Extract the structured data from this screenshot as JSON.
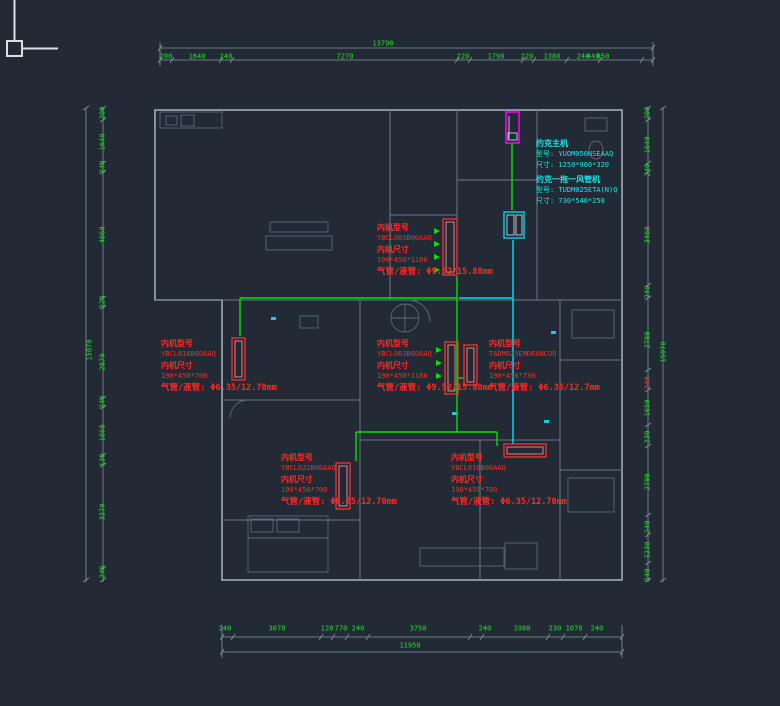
{
  "drawing": {
    "type": "hvac-floor-plan",
    "background": "#212a35",
    "dim_color": "#21e321",
    "annotation_color": "#ff2a24",
    "outdoor_note_color": "#17e8e8",
    "pipe_colors": {
      "gas_line_green": "#00e400",
      "liquid_line_cyan": "#00e0ff"
    },
    "unit_outline_colors": {
      "indoor": "#ff2f2f",
      "outdoor_main": "#ff00ff",
      "ducted": "#00e0ff"
    }
  },
  "dims": {
    "top": {
      "total": "13790",
      "segments": [
        "200",
        "1640",
        "240",
        "7270",
        "220",
        "1790",
        "220",
        "1380",
        "240",
        "440",
        "850"
      ]
    },
    "bottom": {
      "total": "11950",
      "segments": [
        "240",
        "3070",
        "120",
        "770",
        "240",
        "3750",
        "240",
        "1980",
        "230",
        "1070",
        "240"
      ]
    },
    "left": {
      "total": "15070",
      "segments": [
        "200",
        "1640",
        "240",
        "4060",
        "220",
        "2870",
        "240",
        "1860",
        "130",
        "3370",
        "240"
      ]
    },
    "right": {
      "total": "15070",
      "segments": [
        "200",
        "1640",
        "240",
        "3460",
        "240",
        "2780",
        "1650",
        "230",
        "2790",
        "240",
        "1230",
        "240"
      ],
      "red_segment": "240"
    }
  },
  "note_labels": {
    "model": "内机型号",
    "size": "内机尺寸"
  },
  "outdoor_note": {
    "title1": "约克主机",
    "model1": "型号: YUOM050HSEAAQ",
    "size1": "尺寸: 1250*960*320",
    "title2": "约克一拖一风管机",
    "model2": "型号: TUDM025ETA(N)Q",
    "size2": "尺寸: 730*540*250"
  },
  "unit_notes": [
    {
      "location": "living-room",
      "model": "YBCL063B00AAQ",
      "size": "190*450*1180",
      "pipe": "气管/液管: Φ9.52/15.88mm"
    },
    {
      "location": "left-bedroom",
      "model": "YBCL018B00AAQ",
      "size": "190*450*700",
      "pipe": "气管/液管: Φ6.35/12.70mm"
    },
    {
      "location": "center-hall",
      "model": "YBCL063B00AAQ",
      "size": "190*450*1180",
      "pipe": "气管/液管: Φ9.52/15.88mm"
    },
    {
      "location": "right-room",
      "model": "TADM025EMDRANCUQ",
      "size": "190*450*730",
      "pipe": "气管/液管: Φ6.35/12.7mm"
    },
    {
      "location": "bottom-left",
      "model": "YBCL022B00AAQ",
      "size": "190*450*700",
      "pipe": "气管/液管: Φ6.35/12.70mm"
    },
    {
      "location": "bottom-right",
      "model": "YBCL018B00AAQ",
      "size": "190*450*700",
      "pipe": "气管/液管: Φ6.35/12.70mm"
    }
  ]
}
